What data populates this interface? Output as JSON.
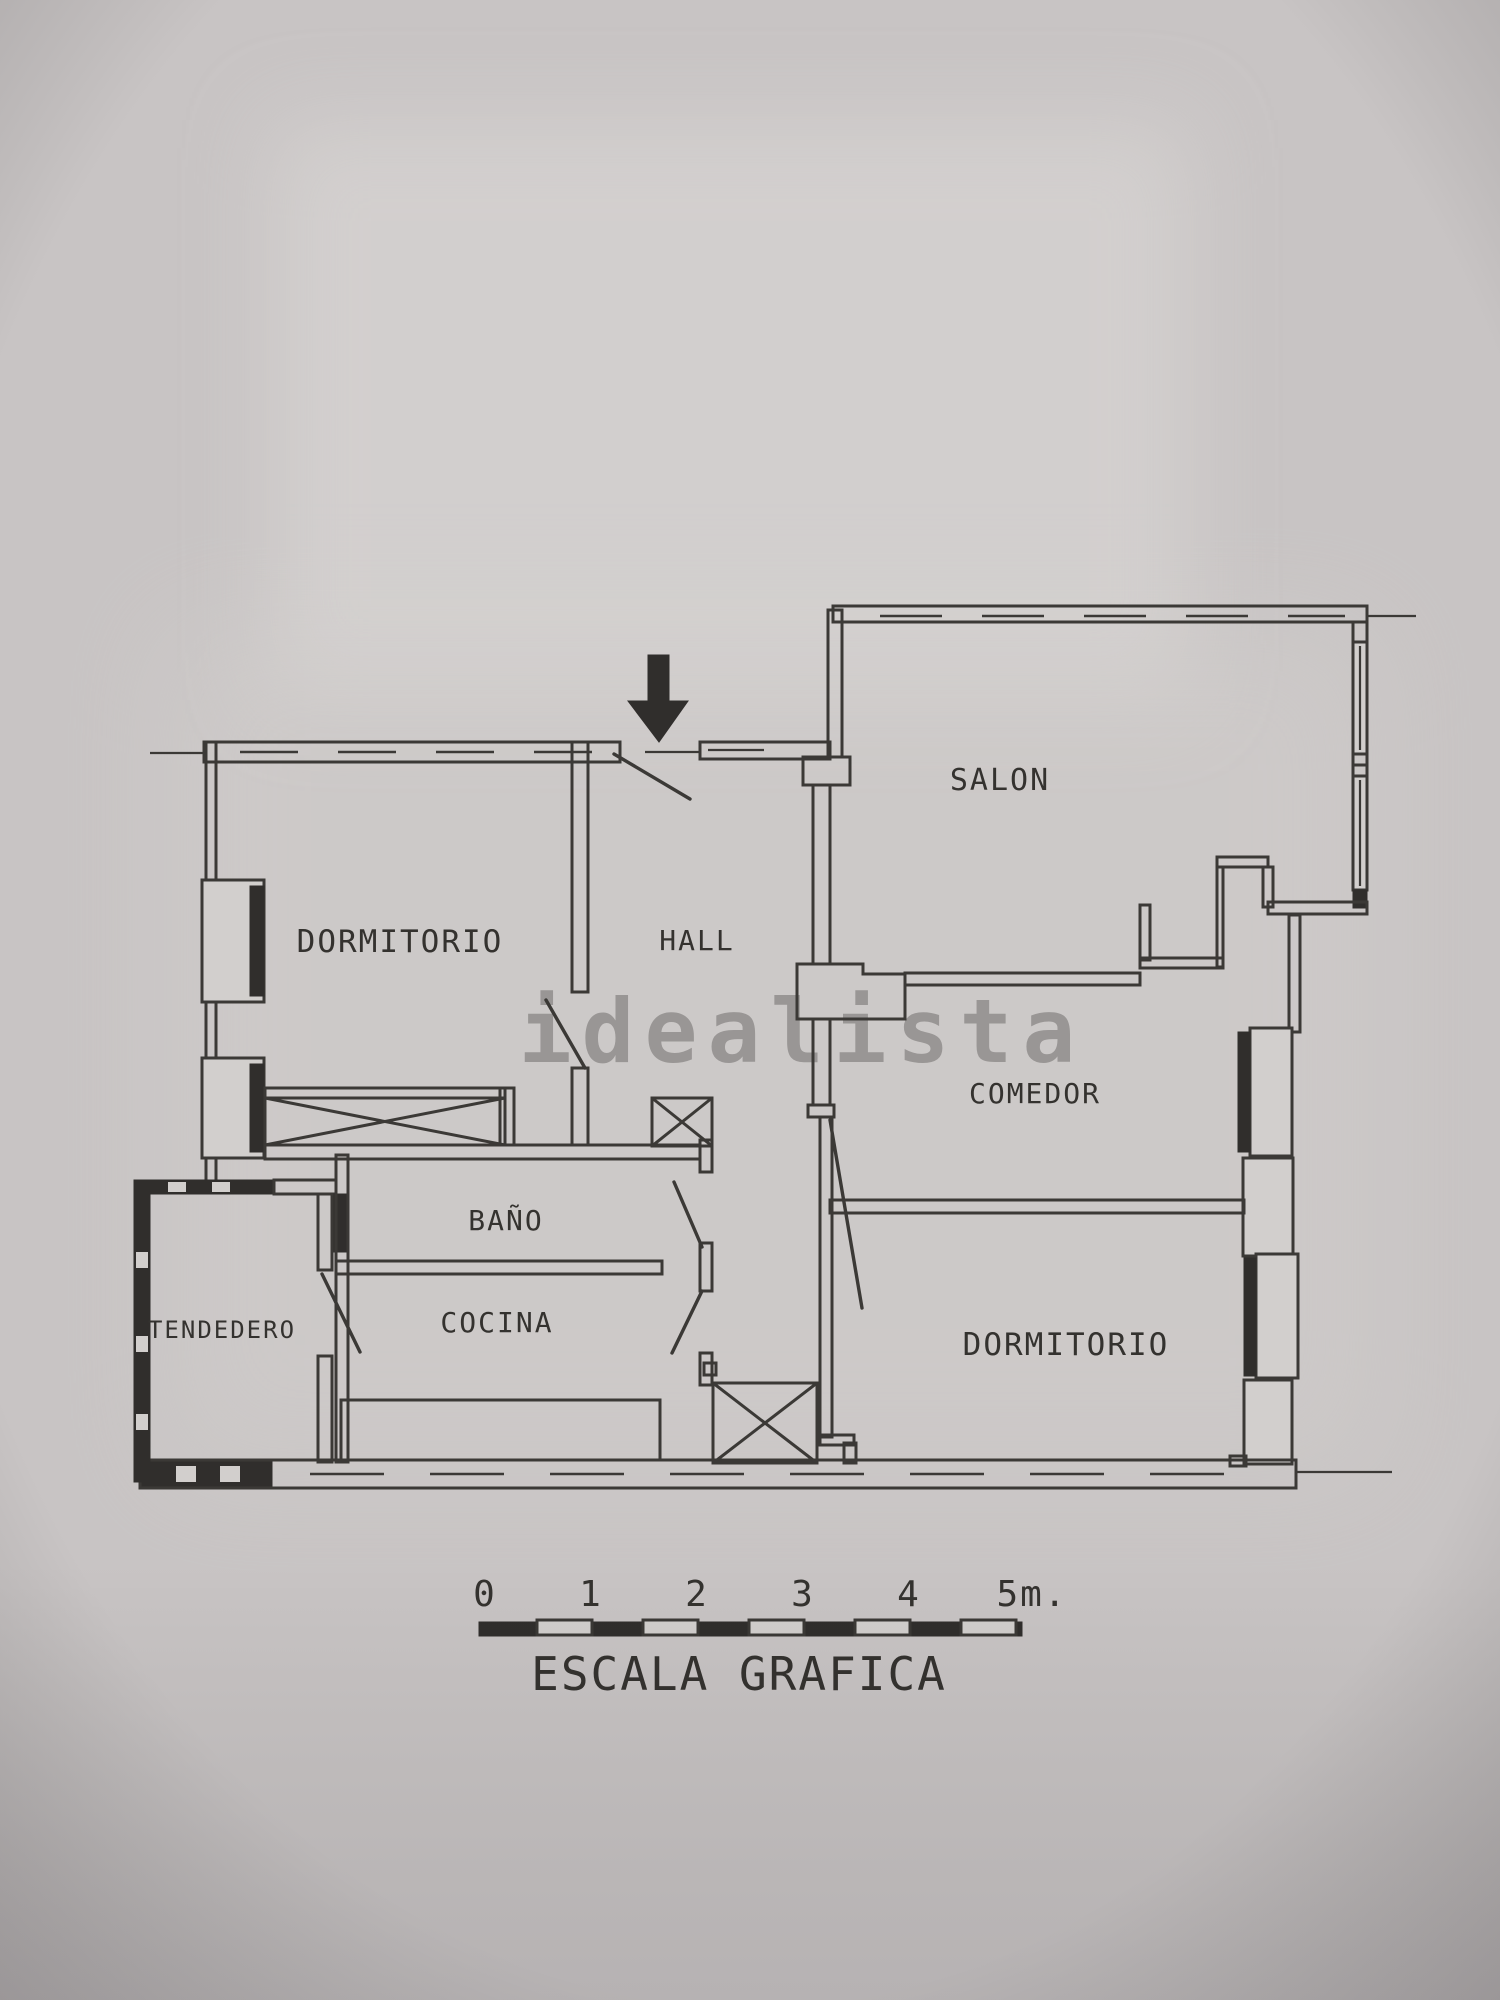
{
  "page": {
    "bg_color": "#c8c4c4",
    "paper_light_color": "#dad7d5",
    "line_color": "#3b3936",
    "hatch_color": "#302e2c",
    "watermark": {
      "text": "idealista",
      "color": "#8e8b8a"
    }
  },
  "floorplan": {
    "entrance_arrow": {
      "icon": "down-arrow"
    },
    "rooms": [
      {
        "id": "dormitorio-1",
        "label": "DORMITORIO"
      },
      {
        "id": "hall",
        "label": "HALL"
      },
      {
        "id": "salon",
        "label": "SALON"
      },
      {
        "id": "comedor",
        "label": "COMEDOR"
      },
      {
        "id": "bano",
        "label": "BAÑO"
      },
      {
        "id": "cocina",
        "label": "COCINA"
      },
      {
        "id": "tendedero",
        "label": "TENDEDERO"
      },
      {
        "id": "dormitorio-2",
        "label": "DORMITORIO"
      }
    ],
    "scale_bar": {
      "ticks": [
        "0",
        "1",
        "2",
        "3",
        "4",
        "5m."
      ],
      "caption": "ESCALA GRAFICA"
    }
  }
}
